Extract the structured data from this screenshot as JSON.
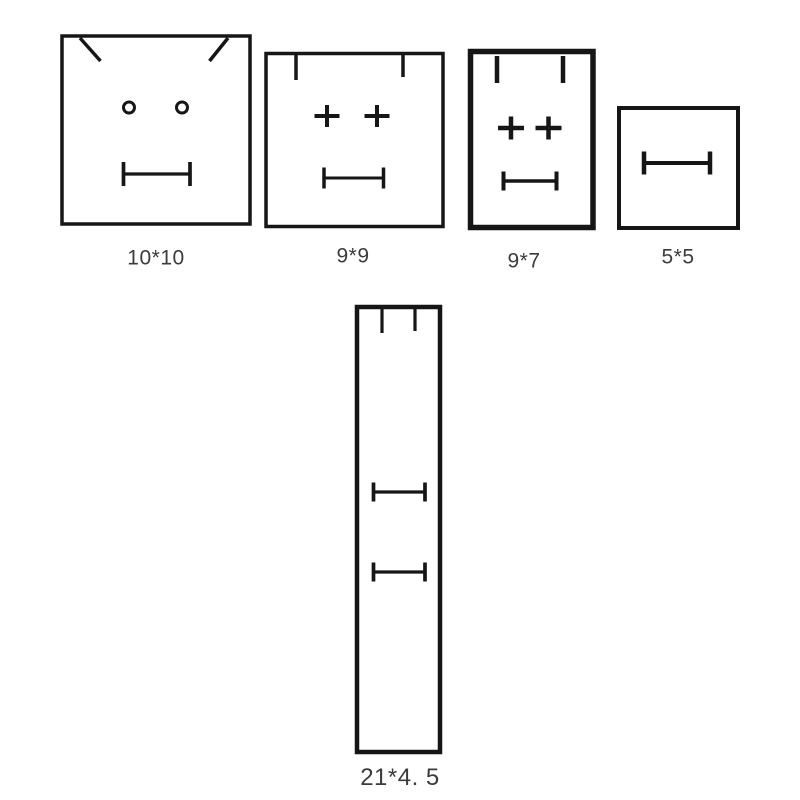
{
  "background": "#ffffff",
  "stroke_color": "#161616",
  "label_color": "#3c3c3c",
  "figures": [
    {
      "id": "square-10x10",
      "label": "10*10",
      "label_pos": {
        "x": 156,
        "y": 258
      },
      "label_size": 21,
      "border": {
        "x": 62,
        "y": 36,
        "w": 188,
        "h": 188,
        "sw": 3.5
      },
      "marks": [
        {
          "type": "line",
          "name": "corner-diagonal-left-icon",
          "x1": 80,
          "y1": 38,
          "x2": 100.5,
          "y2": 61,
          "sw": 3.5
        },
        {
          "type": "line",
          "name": "corner-diagonal-right-icon",
          "x1": 228,
          "y1": 38,
          "x2": 209.5,
          "y2": 61,
          "sw": 3.5
        },
        {
          "type": "circle",
          "name": "eye-circle-left-icon",
          "cx": 129,
          "cy": 107.5,
          "r": 5.5,
          "sw": 3
        },
        {
          "type": "circle",
          "name": "eye-circle-right-icon",
          "cx": 182,
          "cy": 107.5,
          "r": 5.5,
          "sw": 3
        },
        {
          "type": "ibeam",
          "name": "mouth-dimension-line",
          "x1": 123.5,
          "x2": 190,
          "y": 174,
          "cap": 24,
          "sw": 3.2
        }
      ]
    },
    {
      "id": "square-9x9",
      "label": "9*9",
      "label_pos": {
        "x": 353,
        "y": 256
      },
      "label_size": 21,
      "border": {
        "x": 266,
        "y": 53.5,
        "w": 177,
        "h": 173,
        "sw": 3.5
      },
      "marks": [
        {
          "type": "line",
          "name": "top-tick-left-icon",
          "x1": 296,
          "y1": 55,
          "x2": 296,
          "y2": 80,
          "sw": 3.5
        },
        {
          "type": "line",
          "name": "top-tick-right-icon",
          "x1": 403,
          "y1": 55,
          "x2": 403,
          "y2": 77,
          "sw": 3.5
        },
        {
          "type": "plus",
          "name": "eye-plus-left-icon",
          "cx": 327,
          "cy": 116,
          "w": 25,
          "h": 22,
          "sw": 4
        },
        {
          "type": "plus",
          "name": "eye-plus-right-icon",
          "cx": 377,
          "cy": 116,
          "w": 25,
          "h": 22,
          "sw": 4
        },
        {
          "type": "ibeam",
          "name": "mouth-dimension-line",
          "x1": 324,
          "x2": 383.5,
          "y": 178,
          "cap": 21,
          "sw": 3
        }
      ]
    },
    {
      "id": "rect-9x7",
      "label": "9*7",
      "label_pos": {
        "x": 524,
        "y": 261
      },
      "label_size": 21,
      "border": {
        "x": 470.5,
        "y": 51.5,
        "w": 122.5,
        "h": 176,
        "sw": 5.5
      },
      "marks": [
        {
          "type": "line",
          "name": "top-tick-left-icon",
          "x1": 497,
          "y1": 56,
          "x2": 497,
          "y2": 83,
          "sw": 4.5
        },
        {
          "type": "line",
          "name": "top-tick-right-icon",
          "x1": 563,
          "y1": 56,
          "x2": 563,
          "y2": 83,
          "sw": 4.5
        },
        {
          "type": "plus",
          "name": "eye-plus-left-icon",
          "cx": 511,
          "cy": 128,
          "w": 26,
          "h": 23,
          "sw": 4.5
        },
        {
          "type": "plus",
          "name": "eye-plus-right-icon",
          "cx": 548.5,
          "cy": 128,
          "w": 26,
          "h": 23,
          "sw": 4.5
        },
        {
          "type": "ibeam",
          "name": "mouth-dimension-line",
          "x1": 503.5,
          "x2": 556.5,
          "y": 181,
          "cap": 19,
          "sw": 3.5
        }
      ]
    },
    {
      "id": "square-5x5",
      "label": "5*5",
      "label_pos": {
        "x": 678,
        "y": 257
      },
      "label_size": 21,
      "border": {
        "x": 619,
        "y": 108,
        "w": 119,
        "h": 120,
        "sw": 4
      },
      "marks": [
        {
          "type": "ibeam",
          "name": "mouth-dimension-line",
          "x1": 644,
          "x2": 710,
          "y": 163,
          "cap": 23,
          "sw": 4
        }
      ]
    },
    {
      "id": "rect-21x4-5",
      "label": "21*4. 5",
      "label_pos": {
        "x": 400,
        "y": 778
      },
      "label_size": 24,
      "border": {
        "x": 357,
        "y": 307,
        "w": 83,
        "h": 445,
        "sw": 4.5
      },
      "marks": [
        {
          "type": "line",
          "name": "top-tick-left-icon",
          "x1": 382,
          "y1": 309,
          "x2": 382,
          "y2": 333,
          "sw": 3.2
        },
        {
          "type": "line",
          "name": "top-tick-right-icon",
          "x1": 415,
          "y1": 309,
          "x2": 415,
          "y2": 331,
          "sw": 3.2
        },
        {
          "type": "ibeam",
          "name": "upper-dimension-line",
          "x1": 373.5,
          "x2": 425,
          "y": 492,
          "cap": 19,
          "sw": 3.2
        },
        {
          "type": "ibeam",
          "name": "lower-dimension-line",
          "x1": 373.5,
          "x2": 425,
          "y": 572,
          "cap": 19,
          "sw": 3.2
        }
      ]
    }
  ]
}
